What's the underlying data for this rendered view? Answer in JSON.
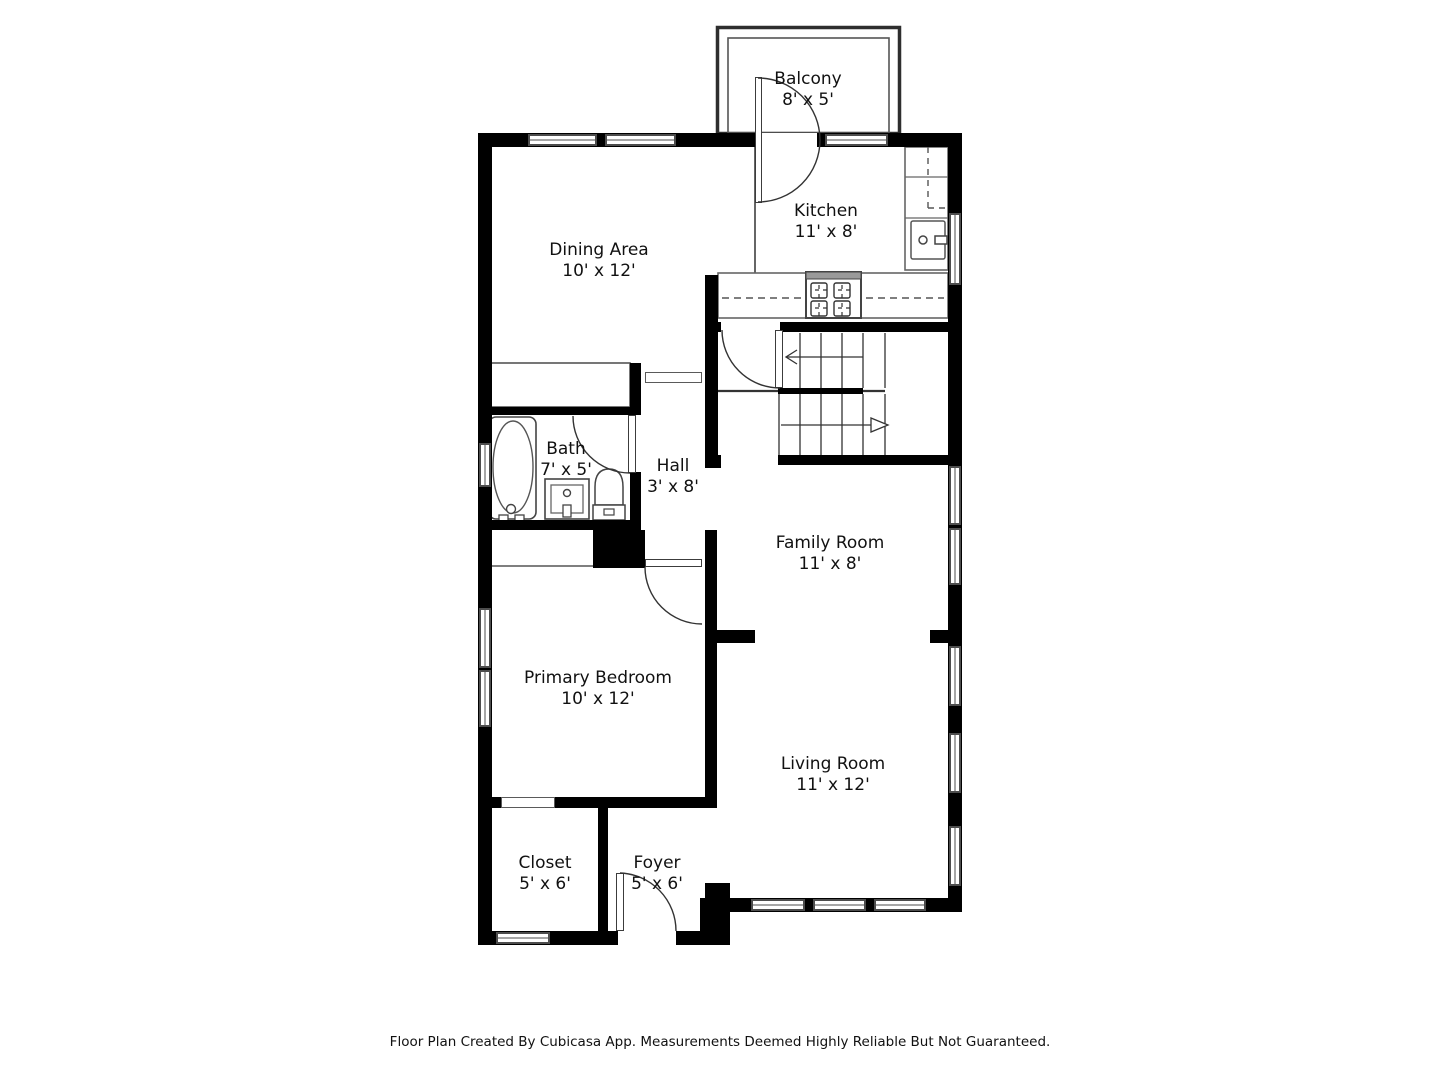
{
  "rooms": [
    {
      "name": "Balcony",
      "dims": "8' x 5'"
    },
    {
      "name": "Kitchen",
      "dims": "11' x 8'"
    },
    {
      "name": "Dining Area",
      "dims": "10' x 12'"
    },
    {
      "name": "Bath",
      "dims": "7' x 5'"
    },
    {
      "name": "Hall",
      "dims": "3' x 8'"
    },
    {
      "name": "Family Room",
      "dims": "11' x 8'"
    },
    {
      "name": "Primary Bedroom",
      "dims": "10' x 12'"
    },
    {
      "name": "Living Room",
      "dims": "11' x 12'"
    },
    {
      "name": "Closet",
      "dims": "5' x 6'"
    },
    {
      "name": "Foyer",
      "dims": "5' x 6'"
    }
  ],
  "stairs": {
    "upper_arrow_direction": "left",
    "lower_arrow_direction": "right"
  },
  "fixtures": [
    "bathtub",
    "vanity-sink",
    "toilet",
    "kitchen-sink",
    "stove",
    "staircase",
    "balcony-door"
  ],
  "colors": {
    "wall": "#000000",
    "line": "#444444",
    "background": "#ffffff"
  },
  "footer": {
    "text": "Floor Plan Created By Cubicasa App. Measurements Deemed Highly Reliable But Not Guaranteed."
  }
}
